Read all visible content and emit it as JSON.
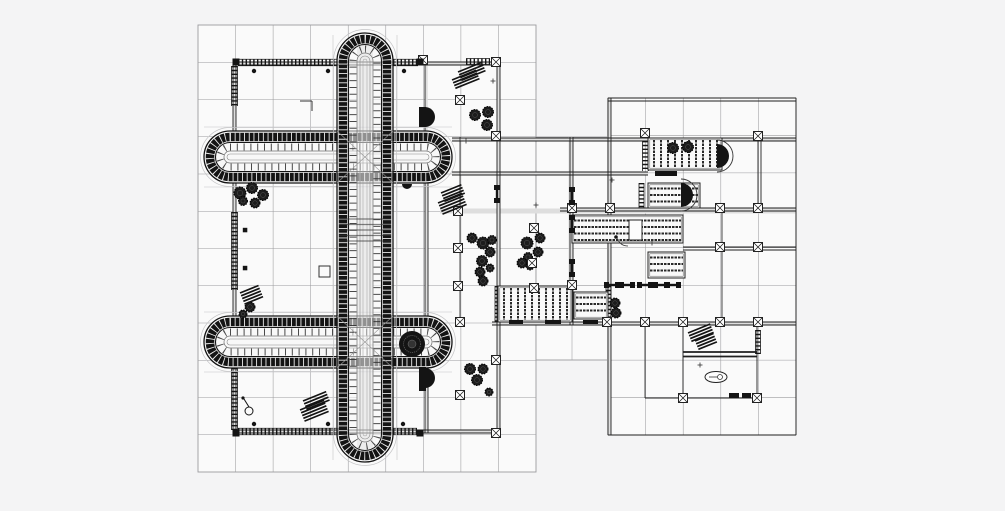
{
  "subject": "architectural-floor-plan-drawing",
  "canvas": {
    "width": 1005,
    "height": 511
  },
  "colors": {
    "background": "#f4f4f5",
    "paper": "#fafafa",
    "grid": "#9b9b9e",
    "soft": "#dedede",
    "faint": "#c4c4c6",
    "ink": "#141414",
    "mid": "#3a3a3a",
    "light_rung": "#ececec"
  },
  "grids": [
    {
      "x": 198,
      "y": 25,
      "w": 338,
      "h": 447,
      "cols": 9,
      "rows": 12
    },
    {
      "x": 608,
      "y": 98,
      "w": 188,
      "h": 337,
      "cols": 5,
      "rows": 9
    },
    {
      "x": 536,
      "y": 137,
      "w": 72,
      "h": 223,
      "cols": 2,
      "rows": 6
    }
  ],
  "soft_bands": [
    [
      365,
      40,
      365,
      458,
      16
    ],
    [
      208,
      157,
      448,
      157,
      16
    ],
    [
      208,
      342,
      448,
      342,
      16
    ],
    [
      440,
      211,
      796,
      211,
      5
    ],
    [
      571,
      137,
      571,
      325,
      5
    ],
    [
      609,
      98,
      609,
      435,
      4
    ],
    [
      492,
      323.5,
      796,
      323.5,
      3
    ],
    [
      452,
      139.5,
      796,
      139.5,
      2.5
    ],
    [
      452,
      173.5,
      648,
      173.5,
      2.5
    ],
    [
      498.5,
      62,
      498.5,
      433,
      2.5
    ],
    [
      426.5,
      62,
      426.5,
      433,
      2.5
    ],
    [
      234.5,
      62,
      234.5,
      433,
      2.5
    ],
    [
      233,
      63.5,
      497,
      63.5,
      2.5
    ],
    [
      233,
      431.5,
      497,
      431.5,
      2.5
    ]
  ],
  "faint_lines": [
    [
      333,
      35,
      333,
      460
    ],
    [
      397,
      35,
      397,
      460
    ],
    [
      204,
      127,
      452,
      127
    ],
    [
      204,
      187,
      452,
      187
    ],
    [
      204,
      312,
      452,
      312
    ],
    [
      204,
      372,
      452,
      372
    ]
  ],
  "wall_lines": [
    [
      233,
      62,
      497,
      62,
      0.9
    ],
    [
      233,
      65,
      497,
      65,
      0.9
    ],
    [
      233,
      430,
      497,
      430,
      0.9
    ],
    [
      233,
      433,
      497,
      433,
      0.9
    ],
    [
      233,
      62,
      233,
      433,
      0.9
    ],
    [
      236,
      62,
      236,
      433,
      0.9
    ],
    [
      425,
      62,
      425,
      433,
      0.9
    ],
    [
      428,
      137,
      428,
      433,
      0.9
    ],
    [
      497,
      62,
      497,
      433,
      0.9
    ],
    [
      500,
      62,
      500,
      433,
      0.9
    ],
    [
      460,
      137,
      460,
      322,
      0.8
    ],
    [
      452,
      138,
      796,
      138,
      0.9
    ],
    [
      452,
      141,
      796,
      141,
      0.9
    ],
    [
      452,
      172,
      648,
      172,
      0.9
    ],
    [
      452,
      175,
      648,
      175,
      0.9
    ],
    [
      560,
      208,
      796,
      208,
      0.9
    ],
    [
      560,
      211,
      796,
      211,
      0.9
    ],
    [
      492,
      322,
      796,
      322,
      0.9
    ],
    [
      492,
      325,
      796,
      325,
      0.9
    ],
    [
      570,
      137,
      570,
      325,
      0.9
    ],
    [
      573,
      137,
      573,
      325,
      0.9
    ],
    [
      608,
      98,
      608,
      435,
      0.9
    ],
    [
      611,
      98,
      611,
      435,
      0.9
    ],
    [
      608,
      98,
      796,
      98,
      0.9
    ],
    [
      608,
      101,
      796,
      101,
      0.9
    ],
    [
      796,
      98,
      796,
      435,
      0.9
    ],
    [
      608,
      435,
      796,
      435,
      0.9
    ],
    [
      758,
      137,
      758,
      208,
      0.9
    ],
    [
      761,
      137,
      761,
      208,
      0.9
    ],
    [
      683,
      247,
      796,
      247,
      0.9
    ],
    [
      683,
      250,
      796,
      250,
      0.9
    ],
    [
      722,
      208,
      722,
      322,
      0.8
    ],
    [
      683,
      322,
      683,
      398,
      0.9
    ],
    [
      757,
      322,
      757,
      398,
      0.9
    ],
    [
      645,
      322,
      645,
      398,
      0.8
    ],
    [
      645,
      398,
      757,
      398,
      0.9
    ],
    [
      683,
      352,
      757,
      352,
      1.8
    ],
    [
      683,
      356.5,
      757,
      356.5,
      1.8
    ]
  ],
  "hatch_bands": [
    {
      "x": 238,
      "y": 62.5,
      "len": 99,
      "o": "h",
      "w": 6.5
    },
    {
      "x": 393,
      "y": 62.5,
      "len": 25,
      "o": "h",
      "w": 6.5
    },
    {
      "x": 466,
      "y": 61.5,
      "len": 24,
      "o": "h",
      "w": 6
    },
    {
      "x": 238,
      "y": 431.5,
      "len": 102,
      "o": "h",
      "w": 6.5
    },
    {
      "x": 393,
      "y": 431.5,
      "len": 24,
      "o": "h",
      "w": 6.5
    },
    {
      "x": 234.5,
      "y": 66,
      "len": 40,
      "o": "v",
      "w": 6
    },
    {
      "x": 234.5,
      "y": 212,
      "len": 78,
      "o": "v",
      "w": 6
    },
    {
      "x": 234.5,
      "y": 330,
      "len": 100,
      "o": "v",
      "w": 6
    },
    {
      "x": 645.5,
      "y": 141,
      "len": 30,
      "o": "v",
      "w": 6
    },
    {
      "x": 641.5,
      "y": 183,
      "len": 25,
      "o": "v",
      "w": 5
    },
    {
      "x": 758,
      "y": 330,
      "len": 24,
      "o": "v",
      "w": 5
    },
    {
      "x": 608.5,
      "y": 286,
      "len": 32,
      "o": "v",
      "w": 5
    },
    {
      "x": 497.5,
      "y": 286,
      "len": 36,
      "o": "v",
      "w": 5
    }
  ],
  "pergolas": [
    {
      "x": 648,
      "y": 138,
      "w": 74,
      "h": 32,
      "o": "v"
    },
    {
      "x": 648,
      "y": 183,
      "w": 52,
      "h": 25,
      "o": "h"
    },
    {
      "x": 572,
      "y": 215,
      "w": 111,
      "h": 28,
      "o": "h"
    },
    {
      "x": 648,
      "y": 252,
      "w": 37,
      "h": 26,
      "o": "h"
    },
    {
      "x": 574,
      "y": 292,
      "w": 34,
      "h": 27,
      "o": "h"
    },
    {
      "x": 498,
      "y": 286,
      "w": 74,
      "h": 36,
      "o": "v"
    }
  ],
  "striped_blocks": [
    {
      "x": 315,
      "y": 141,
      "w": 36,
      "h": 30,
      "step": 2.6
    },
    {
      "x": 285,
      "y": 326,
      "w": 20,
      "h": 34,
      "step": 2.6
    }
  ],
  "vaults": [
    {
      "name": "wing-north",
      "x": 204,
      "y": 131,
      "w": 248,
      "h": 52
    },
    {
      "name": "wing-south",
      "x": 204,
      "y": 316,
      "w": 248,
      "h": 52
    },
    {
      "name": "corridor",
      "x": 337,
      "y": 33,
      "w": 56,
      "h": 429
    }
  ],
  "cross_zones": [
    {
      "x": 337,
      "y": 131,
      "w": 56,
      "h": 52
    },
    {
      "x": 337,
      "y": 316,
      "w": 56,
      "h": 52
    }
  ],
  "corridor_block": {
    "x": 339,
    "y": 219,
    "w": 52,
    "rows": [
      219,
      224.5,
      230,
      235.5,
      241
    ]
  },
  "apses": [
    {
      "cx": 717,
      "cy": 156,
      "r": 12
    },
    {
      "cx": 681,
      "cy": 195,
      "r": 12
    }
  ],
  "d_discs": [
    {
      "cx": 425,
      "cy": 117,
      "r": 10
    },
    {
      "cx": 425,
      "cy": 378,
      "r": 10
    }
  ],
  "d_chunks": [
    [
      419,
      107,
      7,
      20
    ],
    [
      419,
      367,
      7,
      24
    ]
  ],
  "small_half_disc": {
    "cx": 407,
    "cy": 184,
    "r": 5
  },
  "rosette": {
    "cx": 412,
    "cy": 344,
    "r": 13
  },
  "trees": [
    [
      240,
      193,
      6
    ],
    [
      252,
      188,
      5.5
    ],
    [
      263,
      195,
      5.5
    ],
    [
      255,
      203,
      5
    ],
    [
      243,
      201,
      4.5
    ],
    [
      475,
      115,
      5.5
    ],
    [
      488,
      112,
      5.5
    ],
    [
      487,
      125,
      5.5
    ],
    [
      472,
      238,
      5
    ],
    [
      483,
      243,
      6
    ],
    [
      492,
      240,
      4.5
    ],
    [
      490,
      252,
      5
    ],
    [
      482,
      261,
      5.5
    ],
    [
      480,
      272,
      5
    ],
    [
      490,
      268,
      4
    ],
    [
      483,
      281,
      5
    ],
    [
      540,
      238,
      5
    ],
    [
      527,
      243,
      6
    ],
    [
      538,
      252,
      5
    ],
    [
      528,
      257,
      4.5
    ],
    [
      522,
      263,
      5
    ],
    [
      530,
      266,
      4
    ],
    [
      673,
      148,
      5.5
    ],
    [
      688,
      147,
      5.5
    ],
    [
      615,
      303,
      5
    ],
    [
      616,
      313,
      5
    ],
    [
      470,
      369,
      5.5
    ],
    [
      483,
      369,
      5
    ],
    [
      477,
      380,
      5.5
    ],
    [
      489,
      392,
      4
    ],
    [
      250,
      307,
      5
    ],
    [
      243,
      314,
      4
    ]
  ],
  "dots": [
    [
      254,
      71
    ],
    [
      328,
      71
    ],
    [
      404,
      71
    ],
    [
      254,
      424
    ],
    [
      328,
      424
    ],
    [
      403,
      424
    ]
  ],
  "x_markers": [
    [
      423,
      60
    ],
    [
      496,
      62
    ],
    [
      460,
      100
    ],
    [
      496,
      136
    ],
    [
      458,
      211
    ],
    [
      458,
      248
    ],
    [
      458,
      286
    ],
    [
      460,
      322
    ],
    [
      460,
      395
    ],
    [
      496,
      360
    ],
    [
      496,
      433
    ],
    [
      534,
      228
    ],
    [
      532,
      263
    ],
    [
      534,
      288
    ],
    [
      572,
      208
    ],
    [
      572,
      285
    ],
    [
      610,
      208
    ],
    [
      720,
      208
    ],
    [
      758,
      208
    ],
    [
      720,
      247
    ],
    [
      758,
      247
    ],
    [
      645,
      133
    ],
    [
      758,
      136
    ],
    [
      607,
      322
    ],
    [
      645,
      322
    ],
    [
      683,
      322
    ],
    [
      720,
      322
    ],
    [
      758,
      322
    ],
    [
      683,
      398
    ],
    [
      757,
      398
    ]
  ],
  "solid_squares": [
    [
      236,
      62
    ],
    [
      420,
      62
    ],
    [
      236,
      433
    ],
    [
      420,
      433
    ]
  ],
  "small_squares": [
    [
      245,
      230
    ],
    [
      245,
      268
    ]
  ],
  "dumbbells_v": [
    [
      497,
      194
    ],
    [
      572,
      196
    ],
    [
      572,
      224
    ],
    [
      572,
      268
    ]
  ],
  "dumbbells_h": [
    [
      612,
      285
    ],
    [
      627,
      285
    ],
    [
      645,
      285
    ],
    [
      661,
      285
    ],
    [
      673,
      285
    ]
  ],
  "hatch_stacks": [
    {
      "x": 458,
      "y": 72,
      "n": 4,
      "len": 26,
      "ang": -22
    },
    {
      "x": 452,
      "y": 80,
      "n": 4,
      "len": 26,
      "ang": -22
    },
    {
      "x": 441,
      "y": 193,
      "n": 4,
      "len": 22,
      "ang": -22
    },
    {
      "x": 438,
      "y": 203,
      "n": 5,
      "len": 26,
      "ang": -22
    },
    {
      "x": 240,
      "y": 293,
      "n": 5,
      "len": 20,
      "ang": -22
    },
    {
      "x": 303,
      "y": 401,
      "n": 4,
      "len": 25,
      "ang": -22
    },
    {
      "x": 300,
      "y": 410,
      "n": 5,
      "len": 26,
      "ang": -22
    },
    {
      "x": 688,
      "y": 333,
      "n": 4,
      "len": 24,
      "ang": -22
    },
    {
      "x": 695,
      "y": 341,
      "n": 4,
      "len": 20,
      "ang": -22
    }
  ],
  "dashes": [
    [
      509,
      320,
      14,
      4
    ],
    [
      545,
      320,
      16,
      4
    ],
    [
      583,
      320,
      15,
      4
    ],
    [
      655,
      171,
      22,
      5
    ],
    [
      729,
      393,
      10,
      5
    ],
    [
      742,
      393,
      9,
      5
    ]
  ],
  "ticks": [
    [
      493,
      81
    ],
    [
      466,
      141
    ],
    [
      612,
      180
    ],
    [
      652,
      243
    ],
    [
      700,
      365
    ],
    [
      536,
      205
    ]
  ],
  "pool": {
    "cx": 716,
    "cy": 377,
    "rx": 11,
    "ry": 5.5
  },
  "lamp": {
    "cx": 249,
    "cy": 411,
    "r": 4
  },
  "door": {
    "cx": 616,
    "cy": 237
  },
  "table_rect": [
    629,
    220,
    13,
    20
  ],
  "open_square": [
    319,
    266,
    11
  ],
  "l_corner": [
    [
      300,
      101,
      312,
      101
    ],
    [
      312,
      101,
      312,
      111
    ]
  ]
}
